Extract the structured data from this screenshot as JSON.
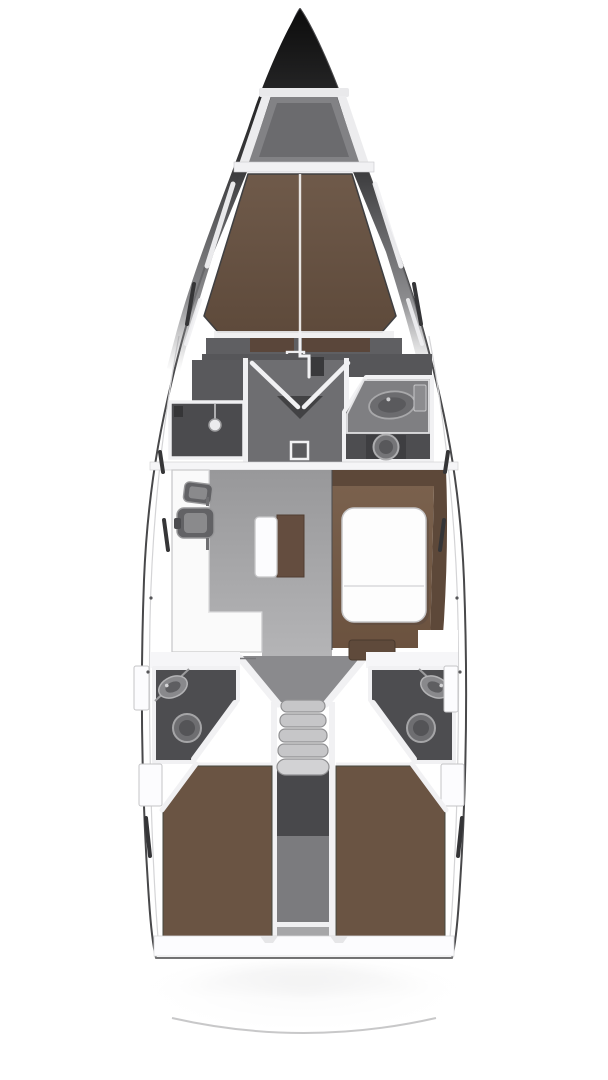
{
  "diagram": {
    "type": "yacht-interior-floor-plan",
    "view": "top-down",
    "orientation": "bow-up",
    "hull": "monohull sailing yacht"
  },
  "colors": {
    "hull-line": "#48484a",
    "hull-inner-line": "#d4d4d6",
    "bow-dark": "#0c0c0c",
    "deck-white": "#f6f6f8",
    "wall-white": "#f1f1f3",
    "locker-gray": "#828285",
    "locker-inner": "#6b6b6e",
    "bulkhead-gray": "#565659",
    "cabinet-gray": "#59595c",
    "vestibule-floor": "#6e6e71",
    "room-dark": "#4d4d50",
    "counter-gray": "#7f7f82",
    "fixture-light": "#a8a8aa",
    "fixture-mid": "#6e6e71",
    "fixture-dark": "#39393b",
    "salon-floor-1": "#98989a",
    "salon-floor-2": "#b4b4b6",
    "galley-white": "#fafafa",
    "sink-dark": "#626265",
    "sink-light": "#8a8a8c",
    "berth-brown-1": "#6f5a4a",
    "berth-brown-2": "#5e4a3b",
    "settee-back": "#5d4839",
    "settee-seat-1": "#7a614d",
    "settee-seat-2": "#6b523f",
    "cushion-brown": "#5f4a3b",
    "seatback-brown": "#644d3f",
    "aft-berth-brown": "#6a5443",
    "table-white": "#fdfdfd",
    "step-gray": "#c6c6c8",
    "engine-dark": "#48484b",
    "engine-mid": "#7b7b7e",
    "engine-light": "#a6a6a8",
    "corridor-gray": "#8a8a8d",
    "window-dark": "#353537",
    "stern-arc": "#c2c2c3",
    "outline-gray": "#c9c9cb"
  },
  "regions": [
    {
      "id": "bow",
      "label": "bow with anchor locker",
      "fixtures": [
        "anchor-locker-hatch",
        "toe-rails"
      ]
    },
    {
      "id": "forward-cabin",
      "label": "forward double cabin with V-berth",
      "fixtures": [
        "v-berth",
        "center-seam",
        "shelf",
        "hatch"
      ]
    },
    {
      "id": "forward-shower",
      "label": "forward shower compartment (port)",
      "fixtures": [
        "shower-head"
      ]
    },
    {
      "id": "vestibule",
      "label": "forward lobby with double doors",
      "fixtures": [
        "double-door-swing",
        "floor-hatch",
        "mast-step"
      ]
    },
    {
      "id": "forward-head",
      "label": "forward head (starboard)",
      "fixtures": [
        "vanity-counter",
        "washbasin",
        "cabinet-panel",
        "toilet"
      ]
    },
    {
      "id": "galley",
      "label": "L-shaped galley (port)",
      "fixtures": [
        "small-sink",
        "large-sink",
        "stove-oval"
      ]
    },
    {
      "id": "salon",
      "label": "salon with U-shaped settee (starboard)",
      "fixtures": [
        "dining-table",
        "u-settee",
        "center-bench",
        "corner-cushion"
      ]
    },
    {
      "id": "aft-head-port",
      "label": "aft head (port)",
      "fixtures": [
        "washbasin",
        "toilet",
        "lockers"
      ]
    },
    {
      "id": "aft-head-starboard",
      "label": "aft head (starboard)",
      "fixtures": [
        "washbasin",
        "toilet",
        "lockers"
      ]
    },
    {
      "id": "companionway",
      "label": "companionway with steps",
      "fixtures": [
        "five-steps",
        "engine-compartment"
      ]
    },
    {
      "id": "aft-cabin-port",
      "label": "aft double cabin (port)",
      "fixtures": [
        "double-berth"
      ]
    },
    {
      "id": "aft-cabin-starboard",
      "label": "aft double cabin (starboard)",
      "fixtures": [
        "double-berth"
      ]
    },
    {
      "id": "stern",
      "label": "transom with swim-platform arc",
      "fixtures": [
        "stern-arc",
        "stern-shadow"
      ]
    }
  ]
}
